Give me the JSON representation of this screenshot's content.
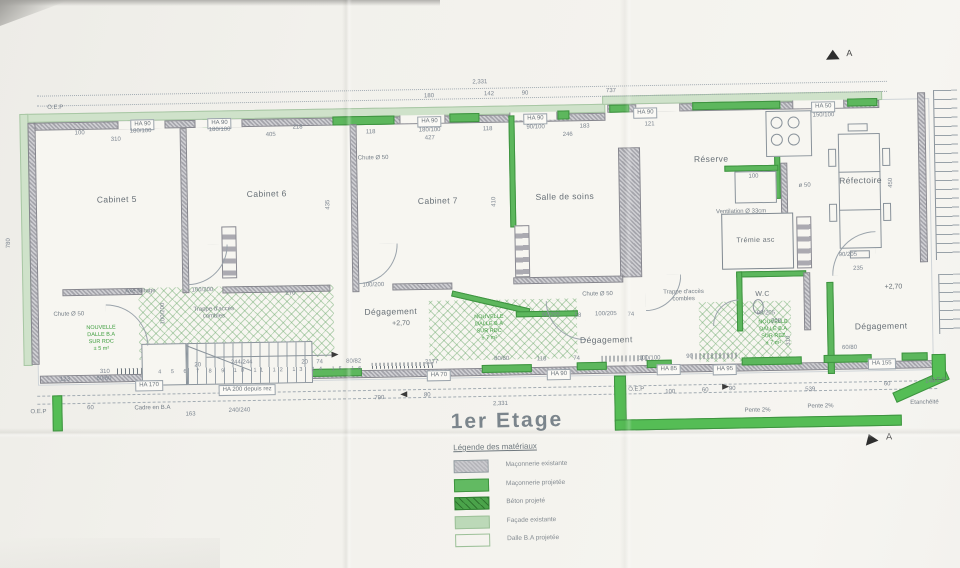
{
  "drawing": {
    "title": "1er Etage",
    "legend_heading": "Légende des matériaux",
    "legend_items": [
      {
        "label": "Maçonnerie existante",
        "type": "existing-masonry"
      },
      {
        "label": "Maçonnerie projetée",
        "type": "projected-masonry"
      },
      {
        "label": "Béton projeté",
        "type": "projected-concrete"
      },
      {
        "label": "Façade existante",
        "type": "existing-facade"
      },
      {
        "label": "Dalle B.A projetée",
        "type": "projected-slab"
      }
    ],
    "section_marker": "A",
    "colors": {
      "new_masonry_green": "#5db75d",
      "facade_green": "#cfe2ca",
      "existing_gray": "#a4a4ab"
    }
  },
  "annotations": {
    "rooms": [
      {
        "t": "Cabinet 5",
        "x": 118,
        "y": 143
      },
      {
        "t": "Cabinet 6",
        "x": 268,
        "y": 140
      },
      {
        "t": "Cabinet 7",
        "x": 439,
        "y": 150
      },
      {
        "t": "Salle de soins",
        "x": 566,
        "y": 148
      },
      {
        "t": "Réserve",
        "x": 713,
        "y": 113
      },
      {
        "t": "Réfectoire",
        "x": 862,
        "y": 137
      },
      {
        "t": "Dégagement",
        "x": 390,
        "y": 260
      },
      {
        "t": "Dégagement",
        "x": 605,
        "y": 292
      },
      {
        "t": "Dégagement",
        "x": 880,
        "y": 283
      }
    ],
    "small_rooms": [
      {
        "t": "Trémie asc",
        "x": 756,
        "y": 196
      },
      {
        "t": "W.C",
        "x": 762,
        "y": 250
      }
    ],
    "levels": [
      {
        "t": "+2,70",
        "x": 400,
        "y": 273
      },
      {
        "t": "+2,70",
        "x": 893,
        "y": 245
      }
    ],
    "notes": [
      {
        "t": "O.E.P",
        "x": 58,
        "y": 51
      },
      {
        "t": "O.E.P",
        "x": 36,
        "y": 355
      },
      {
        "t": "O.E.P",
        "x": 634,
        "y": 343
      },
      {
        "t": "O.E.P",
        "x": 936,
        "y": 339
      },
      {
        "t": "Chute Ø 50",
        "x": 375,
        "y": 107
      },
      {
        "t": "Chute Ø 50",
        "x": 68,
        "y": 258
      },
      {
        "t": "Chute Ø 50",
        "x": 597,
        "y": 247
      },
      {
        "t": "ø 50",
        "x": 806,
        "y": 142
      },
      {
        "t": "Ventilation Ø 33cm",
        "x": 742,
        "y": 167
      },
      {
        "t": "Trappe d'accès\ncombles",
        "x": 213,
        "y": 259
      },
      {
        "t": "Trappe d'accès\ncombles",
        "x": 683,
        "y": 250
      },
      {
        "t": "Cadre en B.A",
        "x": 150,
        "y": 353
      },
      {
        "t": "Axe faîtage",
        "x": 140,
        "y": 236
      },
      {
        "t": "Pente 2%",
        "x": 755,
        "y": 366
      },
      {
        "t": "Pente 2%",
        "x": 818,
        "y": 363
      },
      {
        "t": "Etanchéité",
        "x": 922,
        "y": 361
      }
    ],
    "green_notes": [
      {
        "t": "NOUVELLE\nDALLE B.A\nSUR RDC\n± 5 m²",
        "x": 100,
        "y": 282
      },
      {
        "t": "NOUVELLE\nDALLE B.A\nSUR RDC\n± 7 m²",
        "x": 488,
        "y": 278
      },
      {
        "t": "NOUVELLE\nDALLE B.A\nSUR REZ\n± 7 m²",
        "x": 772,
        "y": 288
      }
    ],
    "ha_labels": [
      {
        "t": "HA 90",
        "x": 145,
        "y": 69
      },
      {
        "t": "HA 90",
        "x": 222,
        "y": 69
      },
      {
        "t": "HA 90",
        "x": 432,
        "y": 71
      },
      {
        "t": "HA 90",
        "x": 538,
        "y": 70
      },
      {
        "t": "HA 90",
        "x": 648,
        "y": 66
      },
      {
        "t": "HA 50",
        "x": 826,
        "y": 63
      },
      {
        "t": "HA 170",
        "x": 147,
        "y": 330
      },
      {
        "t": "HA 70",
        "x": 437,
        "y": 325
      },
      {
        "t": "HA 90",
        "x": 557,
        "y": 326
      },
      {
        "t": "HA 85",
        "x": 667,
        "y": 323
      },
      {
        "t": "HA 95",
        "x": 723,
        "y": 324
      },
      {
        "t": "HA 155",
        "x": 880,
        "y": 321
      },
      {
        "t": "HA 200 depuis rez",
        "x": 245,
        "y": 336
      }
    ],
    "dims": [
      {
        "t": "2,331",
        "x": 483,
        "y": 33
      },
      {
        "t": "180",
        "x": 432,
        "y": 46
      },
      {
        "t": "142",
        "x": 492,
        "y": 45
      },
      {
        "t": "90",
        "x": 528,
        "y": 45
      },
      {
        "t": "737",
        "x": 614,
        "y": 44
      },
      {
        "t": "100",
        "x": 82,
        "y": 77
      },
      {
        "t": "180/100",
        "x": 143,
        "y": 76
      },
      {
        "t": "180/100",
        "x": 222,
        "y": 76
      },
      {
        "t": "218",
        "x": 300,
        "y": 75
      },
      {
        "t": "310",
        "x": 118,
        "y": 84
      },
      {
        "t": "405",
        "x": 273,
        "y": 82
      },
      {
        "t": "118",
        "x": 373,
        "y": 81
      },
      {
        "t": "180/100",
        "x": 432,
        "y": 80
      },
      {
        "t": "118",
        "x": 490,
        "y": 80
      },
      {
        "t": "90/100",
        "x": 538,
        "y": 79
      },
      {
        "t": "183",
        "x": 587,
        "y": 79
      },
      {
        "t": "121",
        "x": 652,
        "y": 78
      },
      {
        "t": "427",
        "x": 432,
        "y": 88
      },
      {
        "t": "246",
        "x": 570,
        "y": 87
      },
      {
        "t": "150/100",
        "x": 826,
        "y": 72
      },
      {
        "t": "100",
        "x": 755,
        "y": 132
      },
      {
        "t": "100/200",
        "x": 202,
        "y": 236
      },
      {
        "t": "270",
        "x": 290,
        "y": 241
      },
      {
        "t": "100/200",
        "x": 373,
        "y": 234
      },
      {
        "t": "90/205",
        "x": 550,
        "y": 267
      },
      {
        "t": "58",
        "x": 577,
        "y": 268
      },
      {
        "t": "100/205",
        "x": 605,
        "y": 267
      },
      {
        "t": "74",
        "x": 630,
        "y": 268
      },
      {
        "t": "90/205",
        "x": 765,
        "y": 269
      },
      {
        "t": "208",
        "x": 775,
        "y": 277
      },
      {
        "t": "90/205",
        "x": 848,
        "y": 212
      },
      {
        "t": "235",
        "x": 858,
        "y": 226
      },
      {
        "t": "244/244",
        "x": 240,
        "y": 309
      },
      {
        "t": "20",
        "x": 196,
        "y": 311
      },
      {
        "t": "20",
        "x": 303,
        "y": 310
      },
      {
        "t": "74",
        "x": 318,
        "y": 310
      },
      {
        "t": "80/82",
        "x": 352,
        "y": 310
      },
      {
        "t": "2177",
        "x": 430,
        "y": 312
      },
      {
        "t": "80/80",
        "x": 500,
        "y": 310
      },
      {
        "t": "118",
        "x": 540,
        "y": 311
      },
      {
        "t": "74",
        "x": 575,
        "y": 311
      },
      {
        "t": "100/100",
        "x": 648,
        "y": 312
      },
      {
        "t": "90",
        "x": 688,
        "y": 311
      },
      {
        "t": "60/80",
        "x": 848,
        "y": 305
      },
      {
        "t": "310",
        "x": 103,
        "y": 316
      },
      {
        "t": "123",
        "x": 63,
        "y": 323
      },
      {
        "t": "60/60",
        "x": 102,
        "y": 323
      },
      {
        "t": "163",
        "x": 188,
        "y": 360
      },
      {
        "t": "240/240",
        "x": 237,
        "y": 357
      },
      {
        "t": "790",
        "x": 377,
        "y": 347
      },
      {
        "t": "80",
        "x": 425,
        "y": 345
      },
      {
        "t": "2,331",
        "x": 498,
        "y": 355
      },
      {
        "t": "100",
        "x": 668,
        "y": 346
      },
      {
        "t": "60",
        "x": 703,
        "y": 345
      },
      {
        "t": "90",
        "x": 730,
        "y": 344
      },
      {
        "t": "539",
        "x": 808,
        "y": 346
      },
      {
        "t": "60",
        "x": 885,
        "y": 342
      },
      {
        "t": "140",
        "x": 928,
        "y": 340
      },
      {
        "t": "60",
        "x": 88,
        "y": 352
      }
    ],
    "vdims": [
      {
        "t": "435",
        "x": 330,
        "y": 152
      },
      {
        "t": "410",
        "x": 496,
        "y": 152
      },
      {
        "t": "450",
        "x": 893,
        "y": 140
      },
      {
        "t": "780",
        "x": 10,
        "y": 185
      },
      {
        "t": "100/200",
        "x": 163,
        "y": 258
      },
      {
        "t": "310",
        "x": 788,
        "y": 296
      }
    ],
    "stair_numbers": {
      "t": "4 5 6 7 8 9 10 11 12 13 14 15 16",
      "x": 260,
      "y": 317
    }
  }
}
